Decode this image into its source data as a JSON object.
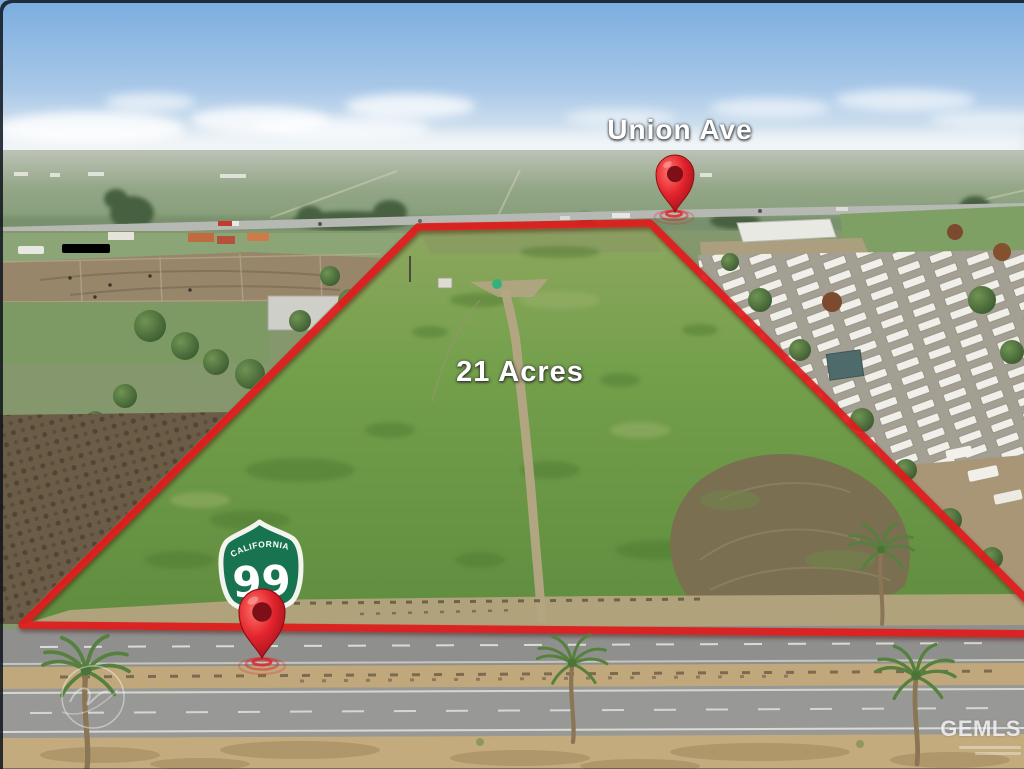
{
  "photo": {
    "street_label": "Union Ave",
    "area_label": "21 Acres",
    "highway_shield": {
      "state": "CALIFORNIA",
      "route": "99"
    },
    "watermark_mls": "GEMLS",
    "colors": {
      "boundary_red": "#e01d1d",
      "pin_red": "#d6202a",
      "shield_green": "#187450",
      "parcel_green": "#6f9747",
      "sky_blue": "#7aadde",
      "road_gray": "#8f908e",
      "dirt_tan": "#c3aa7c"
    }
  }
}
